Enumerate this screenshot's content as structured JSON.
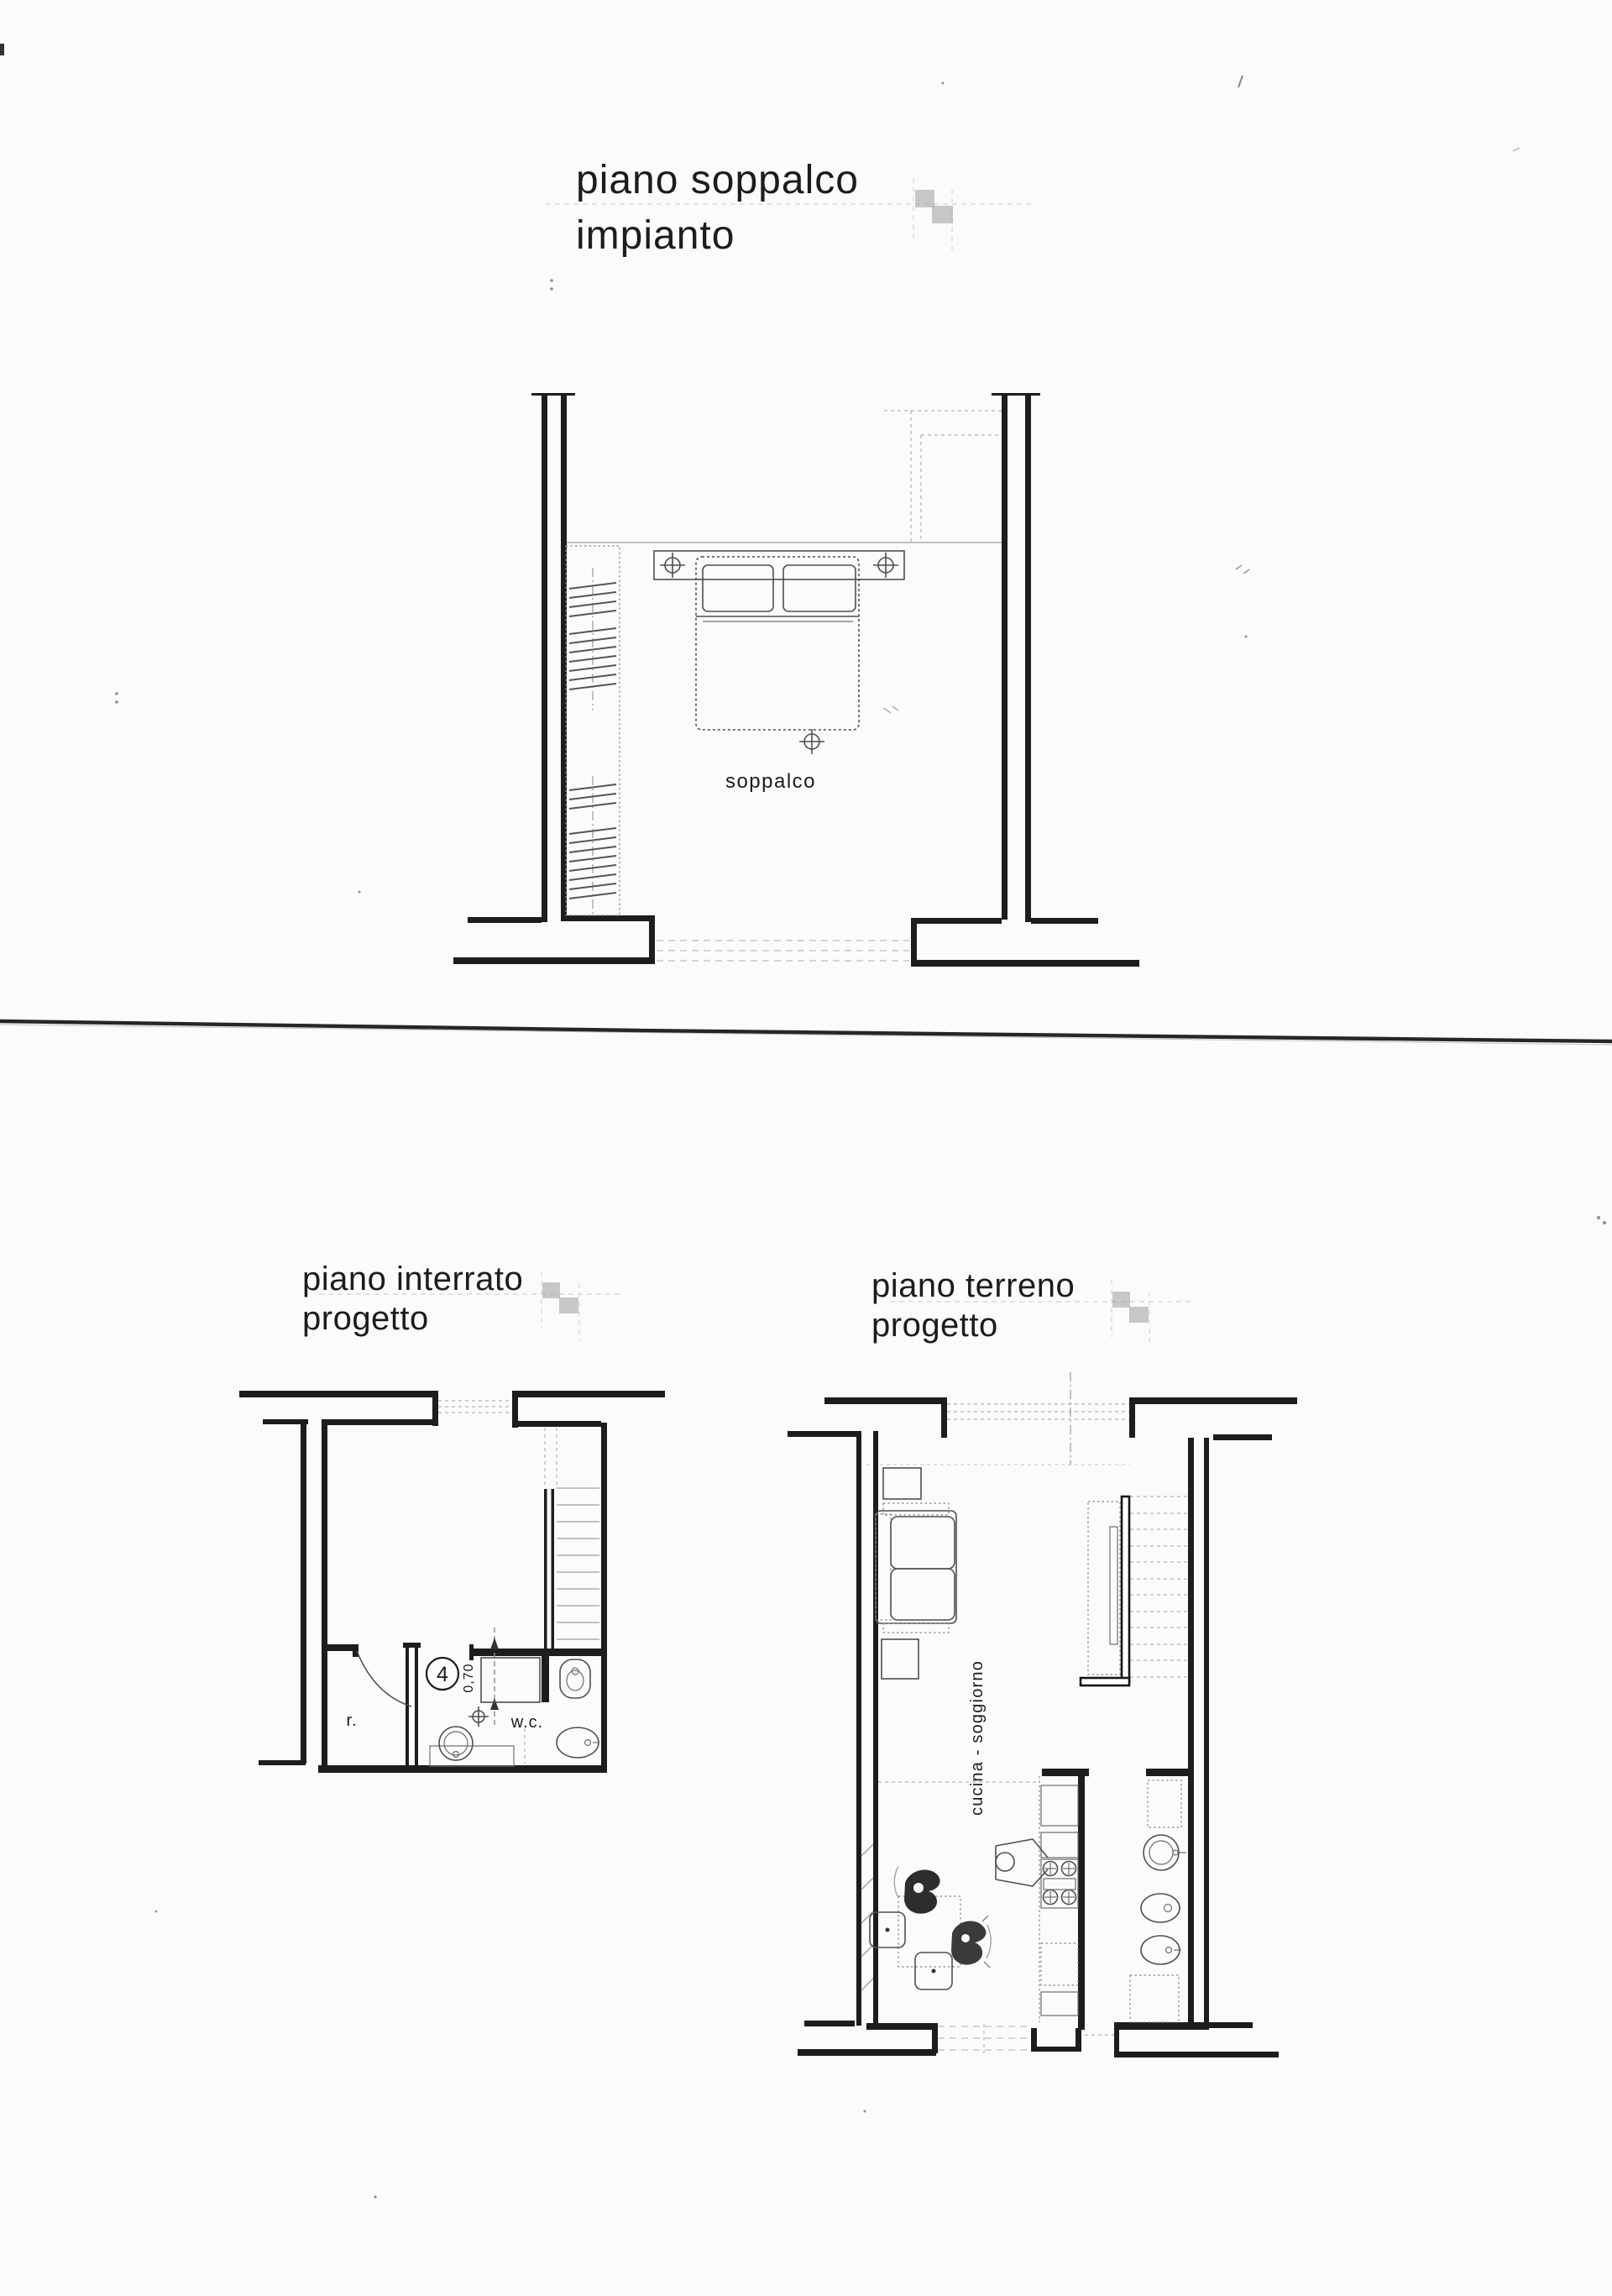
{
  "titles": {
    "soppalco": {
      "line1": "piano soppalco",
      "line2": "impianto"
    },
    "interrato": {
      "line1": "piano interrato",
      "line2": "progetto"
    },
    "terreno": {
      "line1": "piano terreno",
      "line2": "progetto"
    }
  },
  "plan_labels": {
    "soppalco_room": "soppalco",
    "interrato_room": "r.",
    "interrato_wc": "w.c.",
    "interrato_door_number": "4",
    "interrato_door_width": "0,70",
    "terreno_room": "cucina - soggiorno"
  },
  "colors": {
    "paper": "#fbfbf9",
    "ink": "#1d1d1d",
    "furniture_line": "#4f4f4f",
    "faint_line": "#bcbcbc"
  }
}
